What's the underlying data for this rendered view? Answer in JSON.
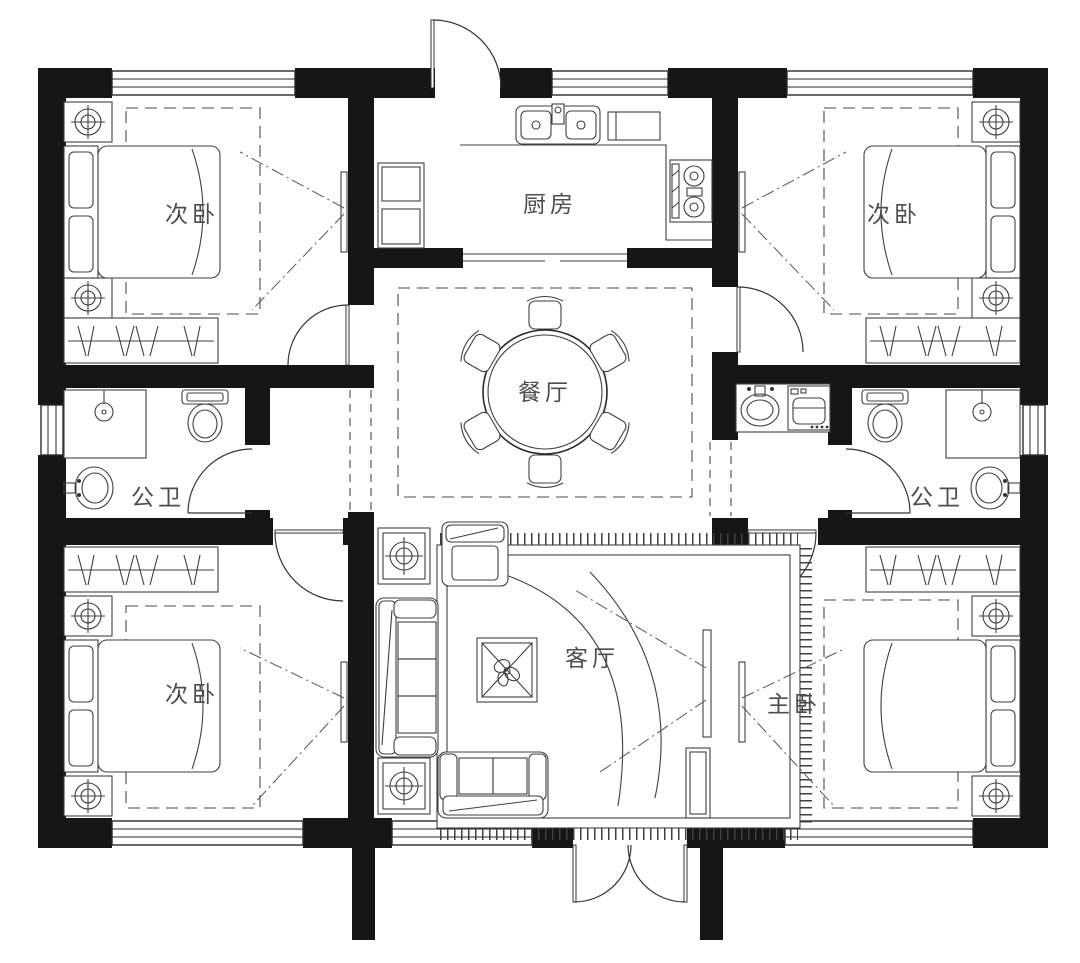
{
  "title": "residential-floor-plan",
  "rooms": [
    {
      "id": "bedroom-top-left",
      "label": "次卧"
    },
    {
      "id": "kitchen",
      "label": "厨房"
    },
    {
      "id": "bedroom-top-right",
      "label": "次卧"
    },
    {
      "id": "dining-room",
      "label": "餐厅"
    },
    {
      "id": "bathroom-left",
      "label": "公卫"
    },
    {
      "id": "bathroom-right",
      "label": "公卫"
    },
    {
      "id": "bedroom-bottom-left",
      "label": "次卧"
    },
    {
      "id": "living-room",
      "label": "客厅"
    },
    {
      "id": "master-bedroom",
      "label": "主卧"
    }
  ],
  "furniture": [
    "double-bed",
    "nightstand-lamp",
    "wardrobe",
    "tv",
    "round-dining-table",
    "stool",
    "three-seat-sofa",
    "armchair",
    "loveseat",
    "coffee-table",
    "area-rug",
    "toilet",
    "shower",
    "washbasin",
    "washing-machine",
    "kitchen-sink",
    "gas-stove",
    "fridge",
    "swing-door",
    "double-entry-door",
    "window"
  ],
  "colors": {
    "wall": "#161616",
    "line": "#3f3f3f",
    "dash": "#4a4a4a",
    "label": "#4d4d4d",
    "background": "#ffffff"
  }
}
